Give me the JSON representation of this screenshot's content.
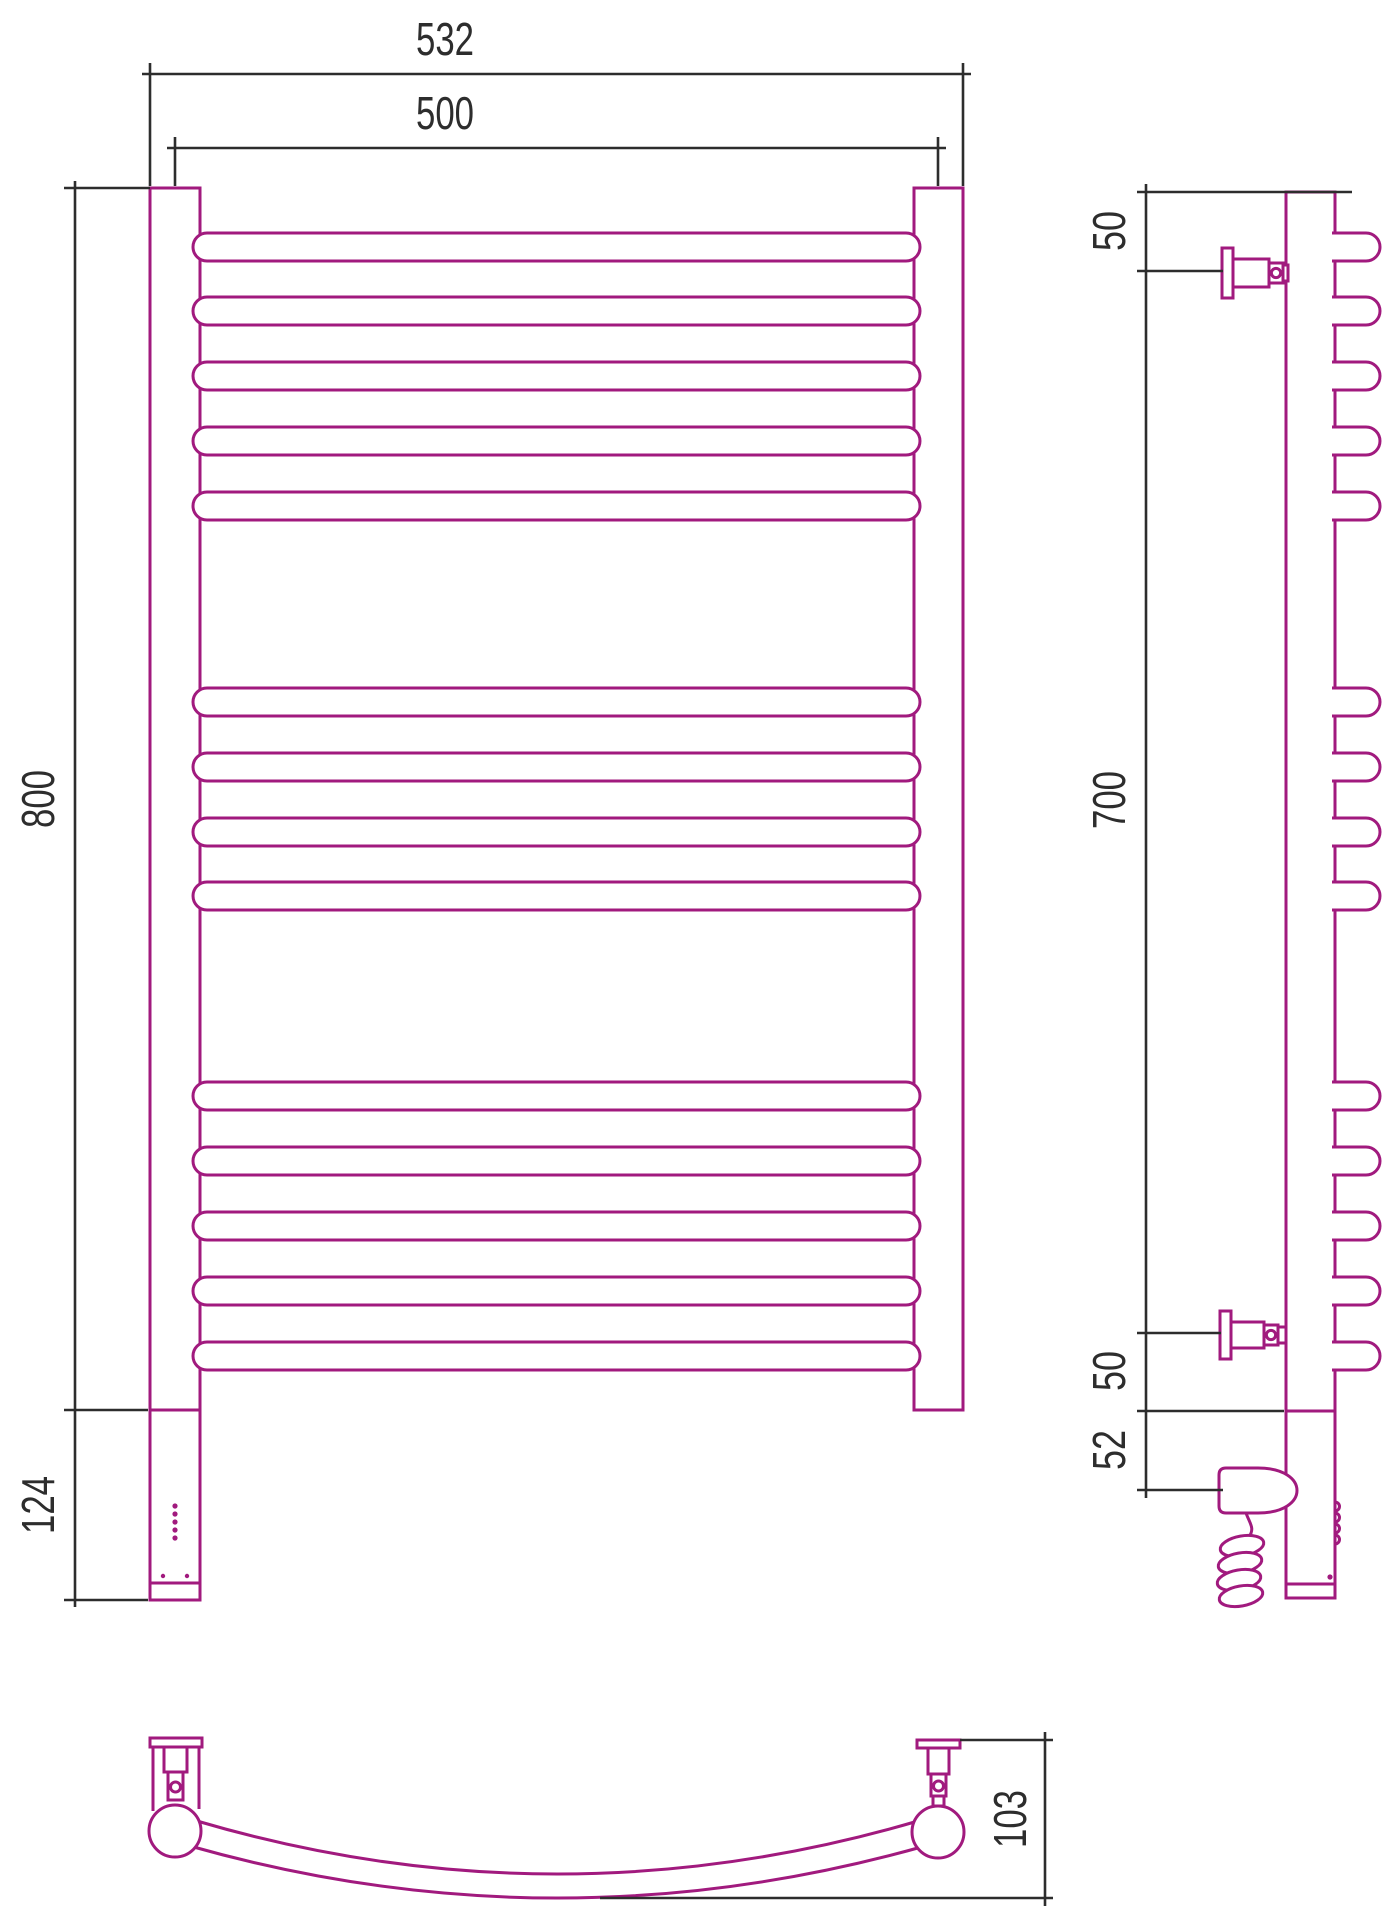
{
  "drawing": {
    "type": "technical-dimension-drawing",
    "subject": "curved ladder towel rail with electric heating element",
    "colors": {
      "outline": "#a11a7e",
      "dimension": "#2d2d2d"
    },
    "front_view": {
      "overall_width": "532",
      "center_span": "500",
      "height": "800",
      "heater_height": "124"
    },
    "side_view": {
      "top_bracket_offset": "50",
      "bracket_span": "700",
      "bottom_bracket_offset": "50",
      "heater_offset": "52"
    },
    "top_view": {
      "depth": "103"
    }
  }
}
